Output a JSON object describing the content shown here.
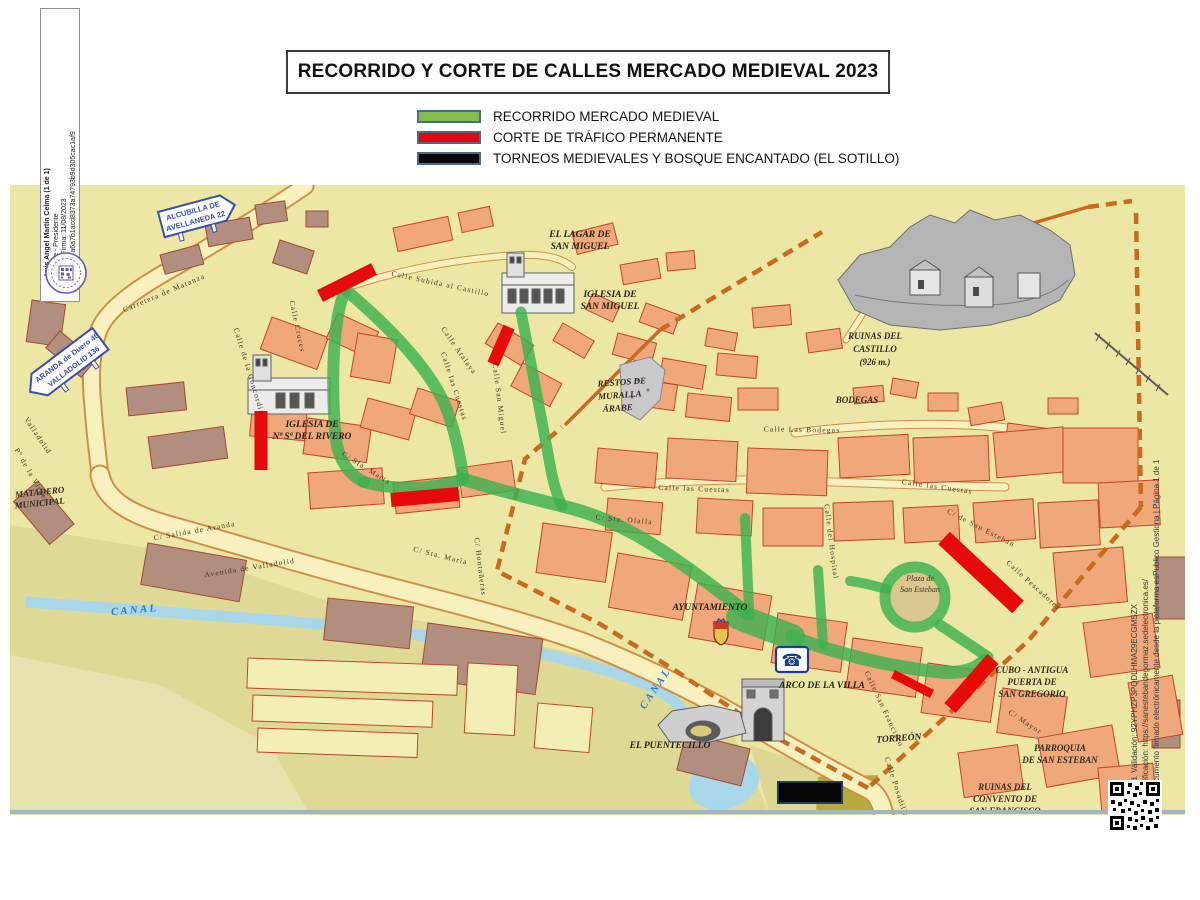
{
  "title": "RECORRIDO Y CORTE DE CALLES MERCADO MEDIEVAL 2023",
  "legend": {
    "items": [
      {
        "label": "RECORRIDO MERCADO MEDIEVAL",
        "color": "#85bb4f"
      },
      {
        "label": "CORTE DE TRÁFICO PERMANENTE",
        "color": "#e30613"
      },
      {
        "label": "TORNEOS MEDIEVALES Y BOSQUE ENCANTADO (EL SOTILLO)",
        "color": "#08080c"
      }
    ]
  },
  "signature_strip": {
    "line1": "Luis Angel Martín Celma (1 de 1)",
    "line2": "Alcalde - Presidente",
    "line3": "Fecha Firma: 11/08/2023",
    "line4": "HASH: a6a7b1acd8373a74793b9d305cac1af9"
  },
  "validation_strip": {
    "line1": "Cód. Validación: 92YPHZP3PQDLHMA29ECGMSZX",
    "line2": "Verificación: https://sanestebandegormaz.sedelectronica.es/",
    "line3": "Documento firmado electrónicamente desde la plataforma esPublico Gestiona | Página 1 de 1"
  },
  "map": {
    "signs": {
      "alcubilla_l1": "ALCUBILLA DE",
      "alcubilla_l2": "AVELLANEDA 22",
      "aranda_l1": "ARANDA de Duero 46",
      "aranda_l2": "VALLADOLID 136"
    },
    "labels": {
      "lagar_l1": "EL LAGAR DE",
      "lagar_l2": "SAN MIGUEL",
      "iglesia_sm_l1": "IGLESIA DE",
      "iglesia_sm_l2": "SAN MIGUEL",
      "ruinas_cast_l1": "RUINAS DEL",
      "ruinas_cast_l2": "CASTILLO",
      "ruinas_cast_l3": "(926 m.)",
      "bodegas": "BODEGAS",
      "restos_l1": "RESTOS DE",
      "restos_l2": "MURALLA",
      "restos_l3": "ÁRABE",
      "rivero_l1": "IGLESIA DE",
      "rivero_l2": "Nª Sª DEL RIVERO",
      "matadero_l1": "MATADERO",
      "matadero_l2": "MUNICIPAL",
      "canal": "CANAL",
      "ayuntamiento": "AYUNTAMIENTO",
      "arco": "ARCO DE LA VILLA",
      "puentecillo": "EL PUENTECILLO",
      "torreon": "TORREÓN",
      "cubo_l1": "CUBO - ANTIGUA",
      "cubo_l2": "PUERTA DE",
      "cubo_l3": "SAN GREGORIO",
      "parroquia_l1": "PARROQUIA",
      "parroquia_l2": "DE SAN ESTEBAN",
      "ruinas_conv_l1": "RUINAS DEL",
      "ruinas_conv_l2": "CONVENTO DE",
      "ruinas_conv_l3": "SAN FRANCISCO",
      "plaza_l1": "Plaza de",
      "plaza_l2": "San Esteban"
    },
    "streets": {
      "carretera_matanza": "Carretera de Matanza",
      "salida_aranda": "C/ Salida de Aranda",
      "avenida_valladolid": "Avenida de Valladolid",
      "valladolid": "Valladolid",
      "virgen": "Pº de la Virgen",
      "concordia": "Calle de la Concordia",
      "cruces": "Calle Cruces",
      "subida_castillo": "Calle Subida al Castillo",
      "atalaya": "Calle Atalaya",
      "cuestas": "Calle las Cuestas",
      "bodegas_st": "Calle Las Bodegas",
      "sta_maria": "C/ Sta. María",
      "sta_olalla": "C/ Sta. Olalla",
      "hontaneras": "C/ Hontañeras",
      "san_miguel_st": "Calle San Miguel",
      "hospital": "Calle del Hospital",
      "san_francisco": "Calle San Francisco",
      "posadillas": "Calle Posadillas",
      "mayor": "C/ Mayor",
      "pescadores": "Calle Pescadores",
      "san_esteban_st": "C/ de San Esteban"
    },
    "icons": {
      "phone": "☎"
    }
  }
}
